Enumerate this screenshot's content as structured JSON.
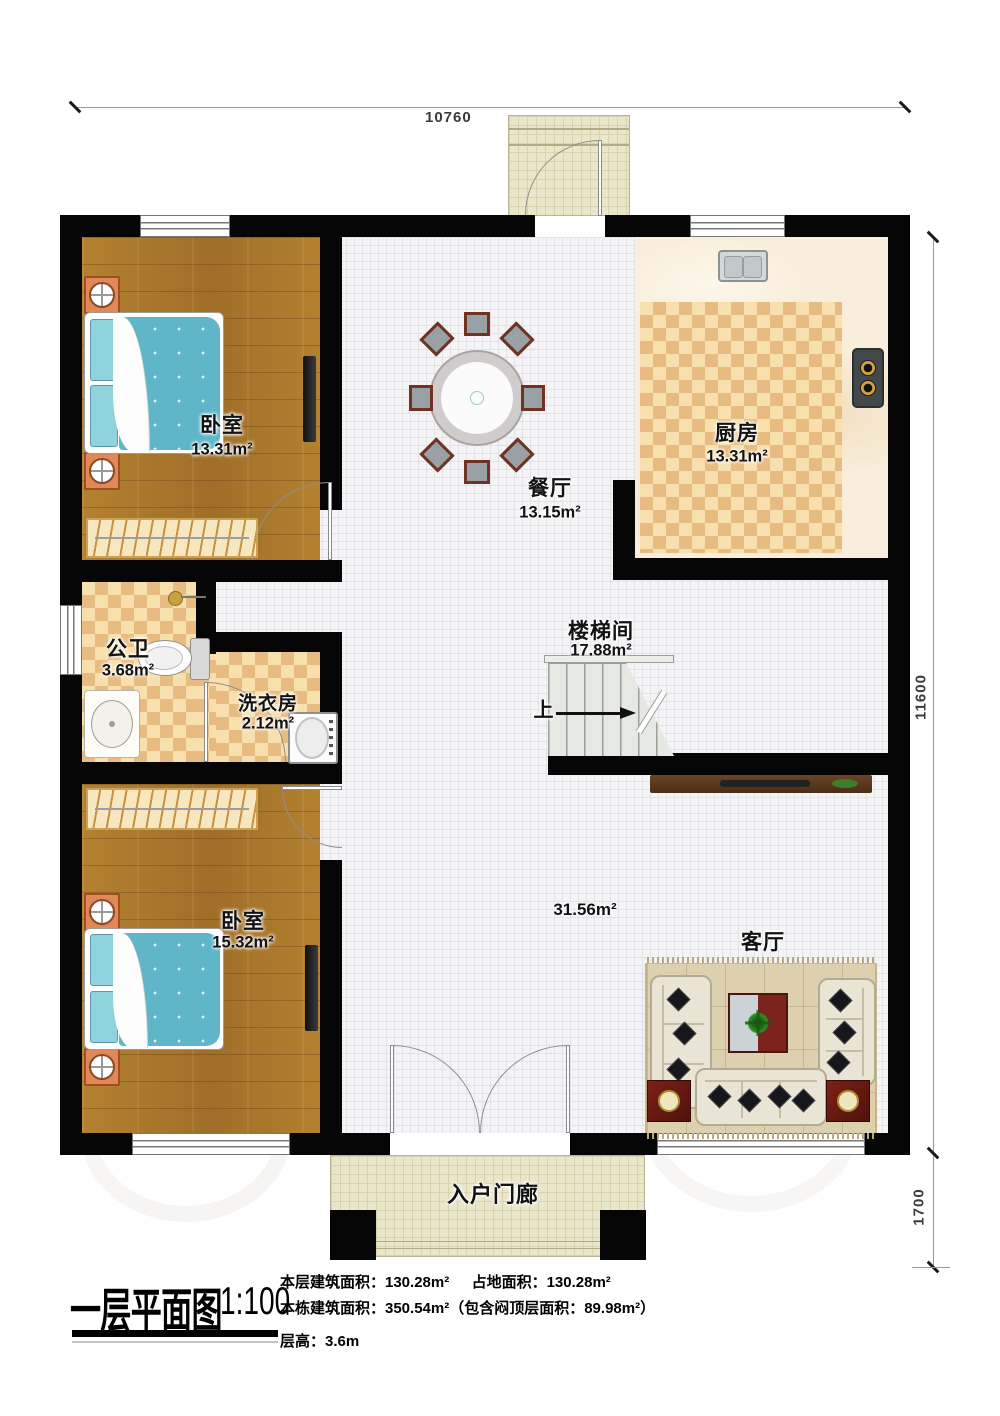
{
  "dims": {
    "top": "10760",
    "right": "11600",
    "right_lower": "1700"
  },
  "rooms": {
    "bedroom1": {
      "name": "卧室",
      "area": "13.31m²"
    },
    "dining": {
      "name": "餐厅",
      "area": "13.15m²"
    },
    "kitchen": {
      "name": "厨房",
      "area": "13.31m²"
    },
    "bathroom": {
      "name": "公卫",
      "area": "3.68m²"
    },
    "laundry": {
      "name": "洗衣房",
      "area": "2.12m²"
    },
    "stairwell": {
      "name": "楼梯间",
      "area": "17.88m²",
      "up": "上"
    },
    "bedroom2": {
      "name": "卧室",
      "area": "15.32m²"
    },
    "living": {
      "name": "客厅",
      "area": "31.56m²"
    },
    "porch": {
      "name": "入户门廊"
    }
  },
  "title": {
    "main": "一层平面图",
    "scale": "1:100",
    "line1a": "本层建筑面积：130.28m²",
    "line1b": "占地面积：130.28m²",
    "line2": "本栋建筑面积：350.54m²（包含闷顶层面积：89.98m²）",
    "line3": "层高：3.6m"
  },
  "colors": {
    "wall": "#060606",
    "wood_floor": "#ab7930",
    "checker_tile": "#e8bc81",
    "bed_blue": "#5fb6c9",
    "accent_red": "#6d1f16"
  }
}
